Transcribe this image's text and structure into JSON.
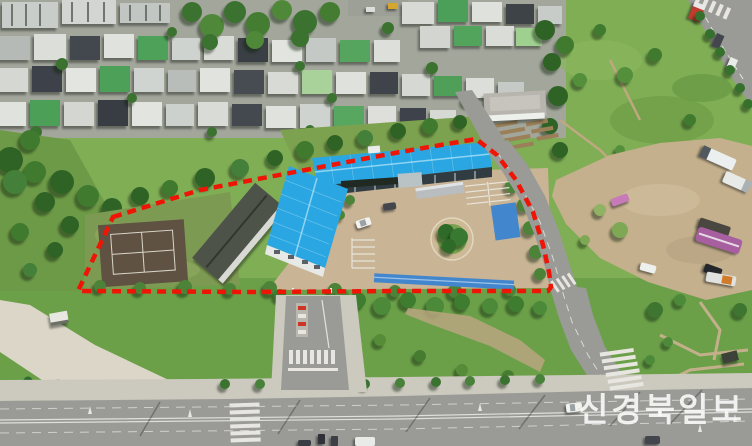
{
  "watermark": {
    "text": "신경북일보"
  },
  "boundary": {
    "style": "dashed",
    "color": "#ee1507"
  },
  "colors": {
    "roof_blue": "#2aa7e2",
    "roof_blue_ridge": "#8fd4f2",
    "canopy_blue": "#4286cd",
    "dark_roof": "#4d5349",
    "court_brown": "#5f5242",
    "court_line_white": "#d9d5c8",
    "courtyard_tan": "#c9b495",
    "dirt_lot_tan": "#c4b08d",
    "grass_green": "#75a24b",
    "field_green": "#7fae55",
    "tree_green": "#3a6c2b",
    "road_gray": "#9a9b97",
    "sidewalk_gray": "#ccc9be",
    "residential_base": "#a2a69b",
    "watermark_white": "rgba(255,255,255,0.85)"
  },
  "vehicles": {
    "white_bus": "#eceff0",
    "white_truck": "#e8eae8",
    "purple_bus": "#a85fa0",
    "dark_truck": "#4a4640",
    "black_car": "#23262a",
    "utility_truck_orange": "#d07a2a",
    "pink_car": "#c77ab8",
    "red_truck": "#c23b2e",
    "white_car": "#f2f2ef",
    "dark_car": "#43474d"
  }
}
